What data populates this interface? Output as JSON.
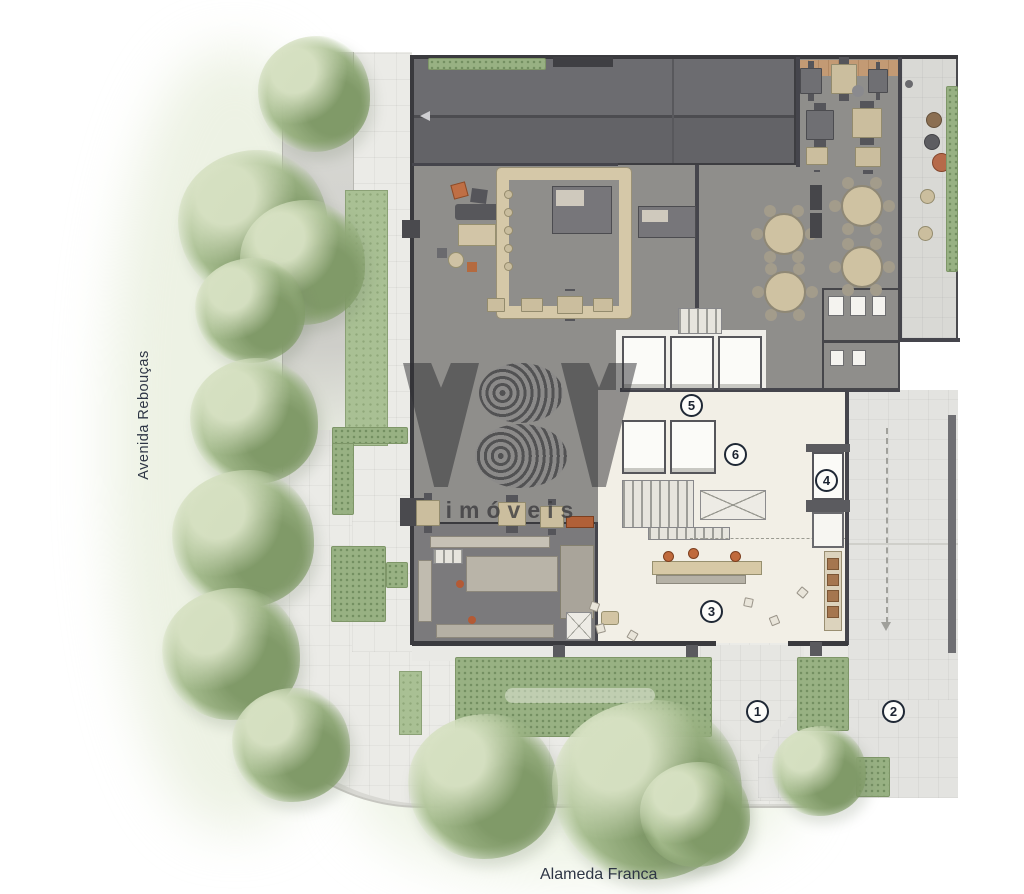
{
  "streets": {
    "left_label": "Avenida Rebouças",
    "bottom_label": "Alameda Franca"
  },
  "watermark": {
    "brand": "YBY",
    "subtitle": "imóveis"
  },
  "markers": [
    {
      "n": "1"
    },
    {
      "n": "2"
    },
    {
      "n": "3"
    },
    {
      "n": "4"
    },
    {
      "n": "5"
    },
    {
      "n": "6"
    }
  ],
  "palette": {
    "floor_gray": "#8f8e8b",
    "ramp_gray": "#68686c",
    "lobby_cream": "#f2efe6",
    "kitchen_gray": "#7b7a7c",
    "sidewalk": "#ebebe7",
    "driveway": "#e3e3e0",
    "hedge_green": "#98b183",
    "tree_green": "#a3ba8b",
    "wood_deck": "#c39a74",
    "accent_orange": "#c06a3c",
    "marker_border": "#1f2835",
    "wall_dark": "#45454c"
  }
}
